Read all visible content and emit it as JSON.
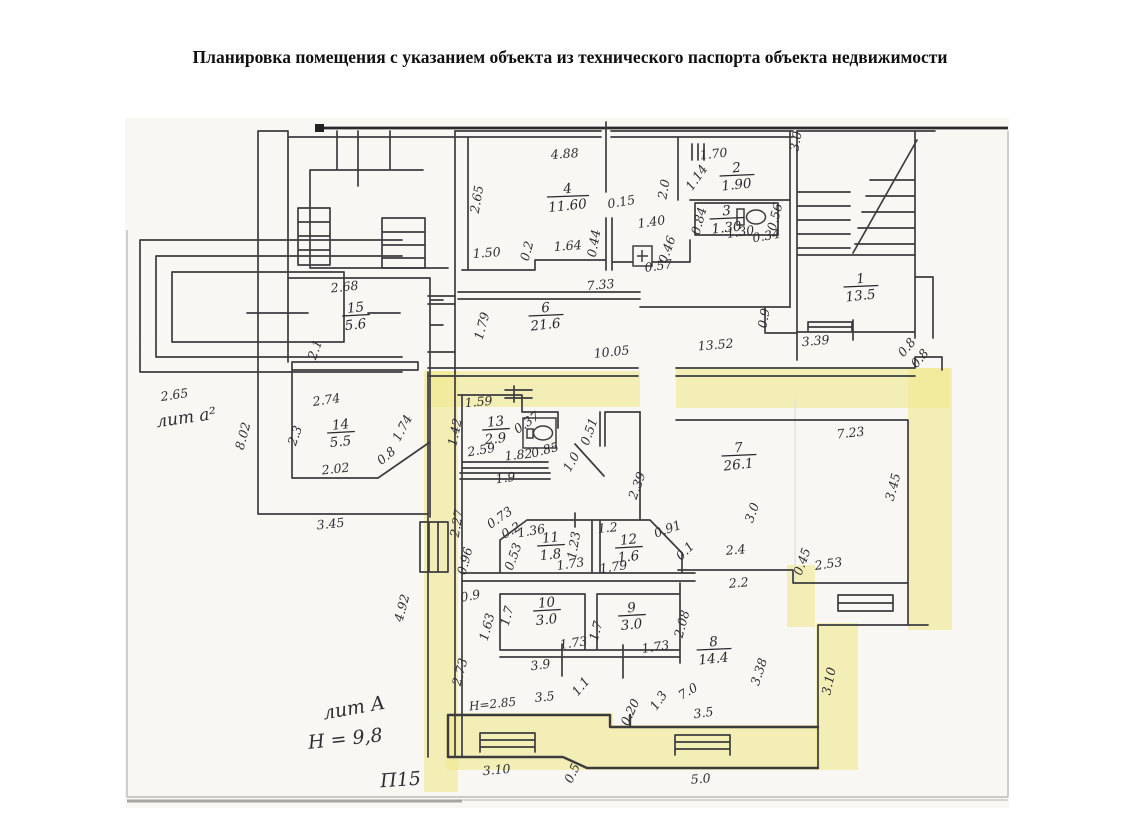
{
  "title": "Планировка помещения с указанием объекта из технического паспорта объекта недвижимости",
  "plan": {
    "highlight_color": "#f1e98e",
    "line_color": "#3c3c40",
    "rooms": [
      {
        "num": "4",
        "area": "11.60",
        "x": 568,
        "y": 197
      },
      {
        "num": "2",
        "area": "1.90",
        "x": 737,
        "y": 176
      },
      {
        "num": "3",
        "area": "1.30",
        "x": 727,
        "y": 219
      },
      {
        "num": "1",
        "area": "13.5",
        "x": 861,
        "y": 287
      },
      {
        "num": "15",
        "area": "5.6",
        "x": 356,
        "y": 316
      },
      {
        "num": "14",
        "area": "5.5",
        "x": 341,
        "y": 433
      },
      {
        "num": "6",
        "area": "21.6",
        "x": 546,
        "y": 316
      },
      {
        "num": "13",
        "area": "2.9",
        "x": 496,
        "y": 430
      },
      {
        "num": "7",
        "area": "26.1",
        "x": 739,
        "y": 456
      },
      {
        "num": "11",
        "area": "1.8",
        "x": 551,
        "y": 546
      },
      {
        "num": "12",
        "area": "1.6",
        "x": 629,
        "y": 548
      },
      {
        "num": "10",
        "area": "3.0",
        "x": 547,
        "y": 611
      },
      {
        "num": "9",
        "area": "3.0",
        "x": 632,
        "y": 616
      },
      {
        "num": "8",
        "area": "14.4",
        "x": 714,
        "y": 650
      }
    ],
    "dims": [
      {
        "t": "4.88",
        "x": 565,
        "y": 158,
        "r": -4
      },
      {
        "t": "2.65",
        "x": 481,
        "y": 200,
        "r": -80
      },
      {
        "t": "0.15",
        "x": 622,
        "y": 206,
        "r": -10
      },
      {
        "t": "1.50",
        "x": 487,
        "y": 257,
        "r": -4
      },
      {
        "t": "0.2",
        "x": 531,
        "y": 252,
        "r": -75
      },
      {
        "t": "1.64",
        "x": 568,
        "y": 250,
        "r": -4
      },
      {
        "t": "0.44",
        "x": 598,
        "y": 244,
        "r": -80
      },
      {
        "t": "1.40",
        "x": 652,
        "y": 226,
        "r": -8
      },
      {
        "t": "2.0",
        "x": 668,
        "y": 190,
        "r": -80
      },
      {
        "t": "1.14",
        "x": 700,
        "y": 180,
        "r": -55
      },
      {
        "t": "1.70",
        "x": 714,
        "y": 158,
        "r": -6
      },
      {
        "t": "0.84",
        "x": 703,
        "y": 222,
        "r": -75
      },
      {
        "t": "1.30",
        "x": 741,
        "y": 236,
        "r": -8
      },
      {
        "t": "0.56",
        "x": 779,
        "y": 218,
        "r": -75
      },
      {
        "t": "0.34",
        "x": 767,
        "y": 240,
        "r": -10
      },
      {
        "t": "0.46",
        "x": 671,
        "y": 251,
        "r": -70
      },
      {
        "t": "0.57",
        "x": 659,
        "y": 270,
        "r": -8
      },
      {
        "t": "2.68",
        "x": 345,
        "y": 291,
        "r": -6
      },
      {
        "t": "2.1",
        "x": 319,
        "y": 351,
        "r": -70
      },
      {
        "t": "2.65",
        "x": 175,
        "y": 399,
        "r": -8
      },
      {
        "t": "8.02",
        "x": 247,
        "y": 437,
        "r": -75
      },
      {
        "t": "2.74",
        "x": 327,
        "y": 404,
        "r": -8
      },
      {
        "t": "2.3",
        "x": 299,
        "y": 437,
        "r": -70
      },
      {
        "t": "1.74",
        "x": 406,
        "y": 430,
        "r": -62
      },
      {
        "t": "0.8",
        "x": 389,
        "y": 459,
        "r": -40
      },
      {
        "t": "2.02",
        "x": 336,
        "y": 473,
        "r": -6
      },
      {
        "t": "3.45",
        "x": 331,
        "y": 528,
        "r": -6
      },
      {
        "t": "1.79",
        "x": 486,
        "y": 327,
        "r": -75
      },
      {
        "t": "7.33",
        "x": 601,
        "y": 289,
        "r": -5
      },
      {
        "t": "10.05",
        "x": 612,
        "y": 356,
        "r": -6
      },
      {
        "t": "13.52",
        "x": 716,
        "y": 349,
        "r": -5
      },
      {
        "t": "0.9",
        "x": 768,
        "y": 319,
        "r": -80
      },
      {
        "t": "3.39",
        "x": 816,
        "y": 345,
        "r": -5
      },
      {
        "t": "0.8",
        "x": 910,
        "y": 350,
        "r": -50
      },
      {
        "t": "0.8",
        "x": 923,
        "y": 361,
        "r": -50
      },
      {
        "t": "3.0",
        "x": 800,
        "y": 142,
        "r": -80
      },
      {
        "t": "1.59",
        "x": 479,
        "y": 406,
        "r": -5
      },
      {
        "t": "1.42",
        "x": 459,
        "y": 433,
        "r": -78
      },
      {
        "t": "0.37",
        "x": 529,
        "y": 426,
        "r": -35
      },
      {
        "t": "2.59",
        "x": 482,
        "y": 454,
        "r": -10
      },
      {
        "t": "1.82",
        "x": 519,
        "y": 459,
        "r": -6
      },
      {
        "t": "0.85",
        "x": 546,
        "y": 454,
        "r": -15
      },
      {
        "t": "1.9",
        "x": 506,
        "y": 482,
        "r": -8
      },
      {
        "t": "1.0",
        "x": 575,
        "y": 464,
        "r": -60
      },
      {
        "t": "0.51",
        "x": 593,
        "y": 433,
        "r": -70
      },
      {
        "t": "2.39",
        "x": 641,
        "y": 487,
        "r": -70
      },
      {
        "t": "7.23",
        "x": 851,
        "y": 437,
        "r": -6
      },
      {
        "t": "3.45",
        "x": 897,
        "y": 488,
        "r": -75
      },
      {
        "t": "3.0",
        "x": 756,
        "y": 514,
        "r": -70
      },
      {
        "t": "2.4",
        "x": 736,
        "y": 554,
        "r": -5
      },
      {
        "t": "0.45",
        "x": 806,
        "y": 563,
        "r": -70
      },
      {
        "t": "2.53",
        "x": 829,
        "y": 568,
        "r": -8
      },
      {
        "t": "2.2",
        "x": 739,
        "y": 587,
        "r": -5
      },
      {
        "t": "0.1",
        "x": 688,
        "y": 554,
        "r": -45
      },
      {
        "t": "0.91",
        "x": 669,
        "y": 533,
        "r": -20
      },
      {
        "t": "1.2",
        "x": 608,
        "y": 532,
        "r": -5
      },
      {
        "t": "0.73",
        "x": 502,
        "y": 521,
        "r": -35
      },
      {
        "t": "0.2",
        "x": 513,
        "y": 534,
        "r": -30
      },
      {
        "t": "1.36",
        "x": 532,
        "y": 535,
        "r": -10
      },
      {
        "t": "0.53",
        "x": 517,
        "y": 558,
        "r": -70
      },
      {
        "t": "0.96",
        "x": 469,
        "y": 562,
        "r": -75
      },
      {
        "t": "2.27",
        "x": 461,
        "y": 524,
        "r": -80
      },
      {
        "t": "1.23",
        "x": 578,
        "y": 546,
        "r": -80
      },
      {
        "t": "1.73",
        "x": 571,
        "y": 568,
        "r": -8
      },
      {
        "t": "1.79",
        "x": 614,
        "y": 571,
        "r": -8
      },
      {
        "t": "4.92",
        "x": 406,
        "y": 609,
        "r": -75
      },
      {
        "t": "0.9",
        "x": 471,
        "y": 600,
        "r": -10
      },
      {
        "t": "1.63",
        "x": 491,
        "y": 628,
        "r": -75
      },
      {
        "t": "1.7",
        "x": 511,
        "y": 617,
        "r": -75
      },
      {
        "t": "1.73",
        "x": 574,
        "y": 647,
        "r": -8
      },
      {
        "t": "3.9",
        "x": 541,
        "y": 669,
        "r": -8
      },
      {
        "t": "1.7",
        "x": 600,
        "y": 632,
        "r": -75
      },
      {
        "t": "1.73",
        "x": 656,
        "y": 651,
        "r": -8
      },
      {
        "t": "2.08",
        "x": 686,
        "y": 625,
        "r": -75
      },
      {
        "t": "3.38",
        "x": 763,
        "y": 673,
        "r": -72
      },
      {
        "t": "2.73",
        "x": 464,
        "y": 673,
        "r": -75
      },
      {
        "t": "3.5",
        "x": 545,
        "y": 701,
        "r": -6
      },
      {
        "t": "1.1",
        "x": 584,
        "y": 689,
        "r": -50
      },
      {
        "t": "0.20",
        "x": 634,
        "y": 714,
        "r": -65
      },
      {
        "t": "1.3",
        "x": 662,
        "y": 703,
        "r": -55
      },
      {
        "t": "7.0",
        "x": 690,
        "y": 695,
        "r": -30
      },
      {
        "t": "3.5",
        "x": 704,
        "y": 717,
        "r": -8
      },
      {
        "t": "3.10",
        "x": 833,
        "y": 682,
        "r": -78
      },
      {
        "t": "3.10",
        "x": 497,
        "y": 774,
        "r": -5
      },
      {
        "t": "0.5",
        "x": 576,
        "y": 775,
        "r": -65
      },
      {
        "t": "5.0",
        "x": 701,
        "y": 783,
        "r": -5
      }
    ],
    "notes": [
      {
        "t": "лит а²",
        "x": 187,
        "y": 423,
        "r": -8,
        "s": 17
      },
      {
        "t": "лит А",
        "x": 355,
        "y": 714,
        "r": -10,
        "s": 19
      },
      {
        "t": "Н = 9,8",
        "x": 346,
        "y": 745,
        "r": -6,
        "s": 19
      },
      {
        "t": "П15",
        "x": 401,
        "y": 786,
        "r": -4,
        "s": 19
      },
      {
        "t": "Н=2.85",
        "x": 493,
        "y": 708,
        "r": -6,
        "s": 12
      }
    ]
  }
}
